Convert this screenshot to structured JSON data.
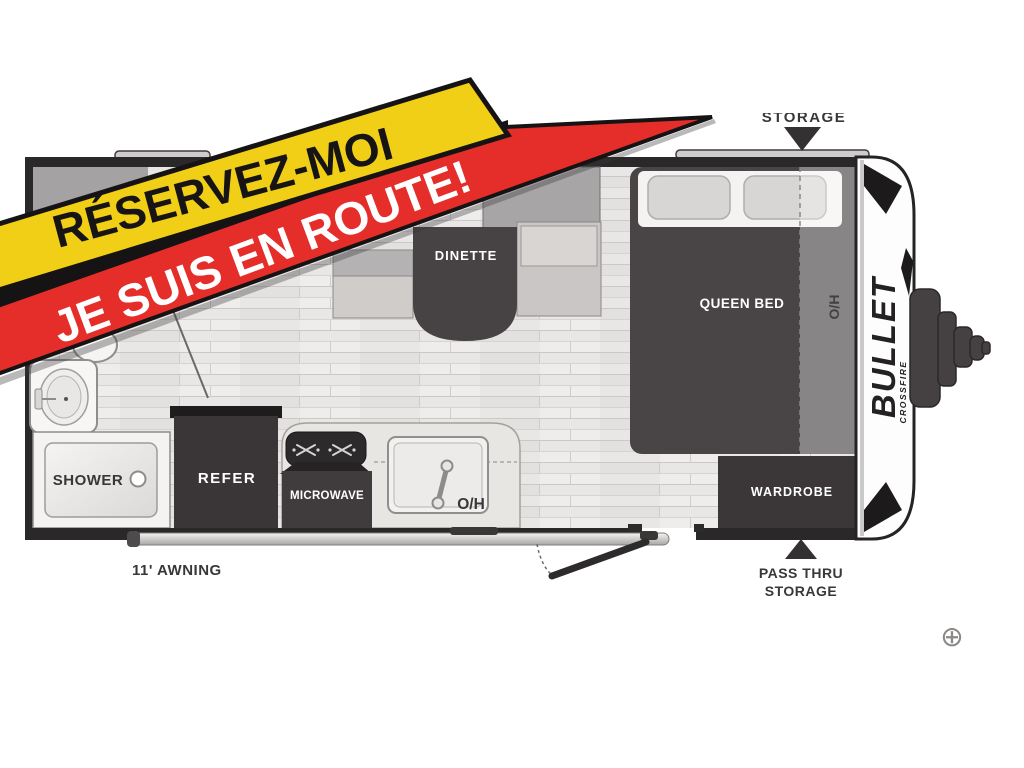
{
  "banner": {
    "line1": "RÉSERVEZ-MOI",
    "line2": "JE SUIS EN ROUTE!",
    "colors": {
      "yellow": "#f2cf17",
      "red": "#e52d29",
      "edge": "#161314",
      "text_dark": "#171415",
      "text_light": "#ffffff"
    }
  },
  "trailer": {
    "brand": "BULLET",
    "brand_sub": "CROSSFIRE",
    "rooms": {
      "dinette": "DINETTE",
      "queen_bed": "QUEEN BED",
      "overhead_bedroom": "O/H",
      "overhead_kitchen": "O/H",
      "wardrobe": "WARDROBE",
      "refer": "REFER",
      "microwave": "MICROWAVE",
      "shower": "SHOWER"
    },
    "callouts": {
      "storage_top": "STORAGE",
      "awning": "11' AWNING",
      "pass_thru_line1": "PASS THRU",
      "pass_thru_line2": "STORAGE"
    }
  },
  "controls": {
    "zoom_icon": "⊕"
  }
}
